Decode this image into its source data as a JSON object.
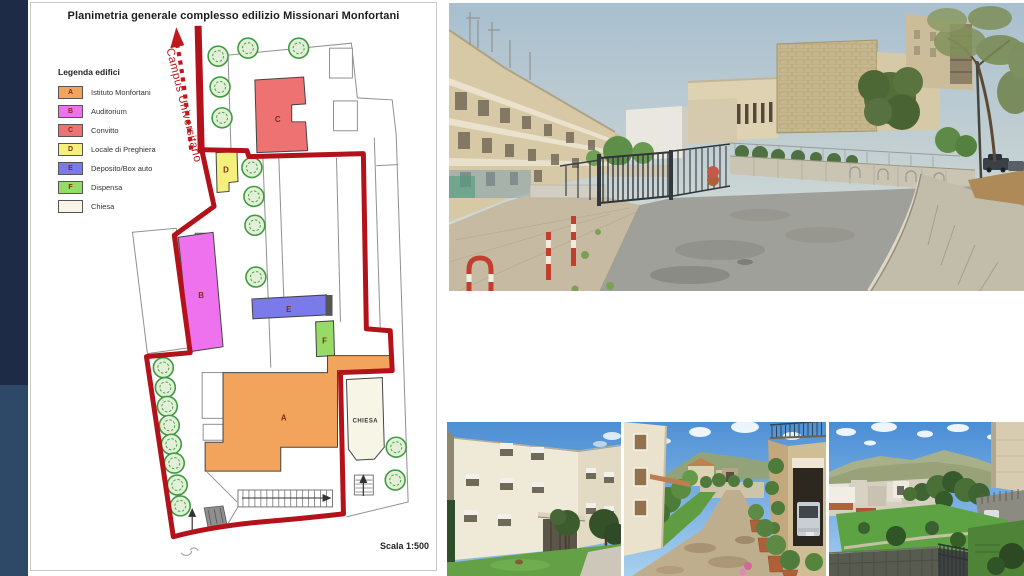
{
  "sidebar": {
    "top_color": "#1d2b46",
    "bottom_color": "#2d4967"
  },
  "plan": {
    "title": "Planimetria generale complesso edilizio Missionari Monfortani",
    "road_label": "Campus Universitario",
    "scale_label": "Scala 1:500",
    "boundary_color": "#b3121a",
    "arrow_color": "#c0181c",
    "legend": {
      "heading": "Legenda edifici",
      "items": [
        {
          "letter": "A",
          "label": "Istituto Monfortani",
          "color": "#f2a45c"
        },
        {
          "letter": "B",
          "label": "Auditorium",
          "color": "#ee72ee"
        },
        {
          "letter": "C",
          "label": "Convitto",
          "color": "#ef7272"
        },
        {
          "letter": "D",
          "label": "Locale di Preghiera",
          "color": "#f5f07e"
        },
        {
          "letter": "E",
          "label": "Deposito/Box auto",
          "color": "#7a7ae8"
        },
        {
          "letter": "F",
          "label": "Dispensa",
          "color": "#97db66"
        },
        {
          "letter": "",
          "label": "Chiesa",
          "color": "#f7f5e6"
        }
      ]
    },
    "building_labels": {
      "a": "A",
      "b": "B",
      "c": "C",
      "d": "D",
      "e": "E",
      "f": "F",
      "chiesa": "CHIESA"
    }
  }
}
